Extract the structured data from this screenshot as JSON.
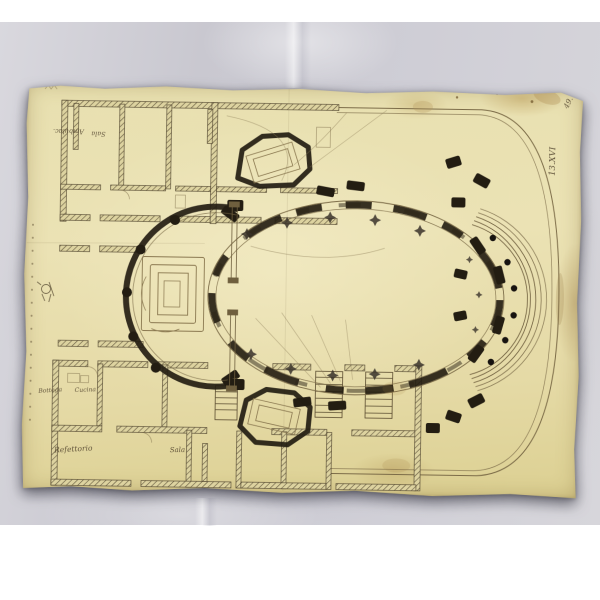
{
  "palette": {
    "page_white": "#ffffff",
    "backdrop_gray": "#cbcad2",
    "paper_yellow": "#e9e0ae",
    "ink_dark": "#1f1a10",
    "ink_light": "#7c6c48",
    "label_ink": "#4a3c28"
  },
  "archive_marks": {
    "corner_number": "49.",
    "shelf_mark": "13.XVI"
  },
  "room_labels": {
    "ambulatory": "Ambulac.",
    "upper_sala": "Sala",
    "bottega": "Bottega",
    "cucina": "Cucina",
    "refettorio": "Refettorio",
    "lower_sala": "Sala"
  },
  "icons": {
    "monogram": "pencil-monogram",
    "margin_dots": "dotted-margin-line"
  }
}
